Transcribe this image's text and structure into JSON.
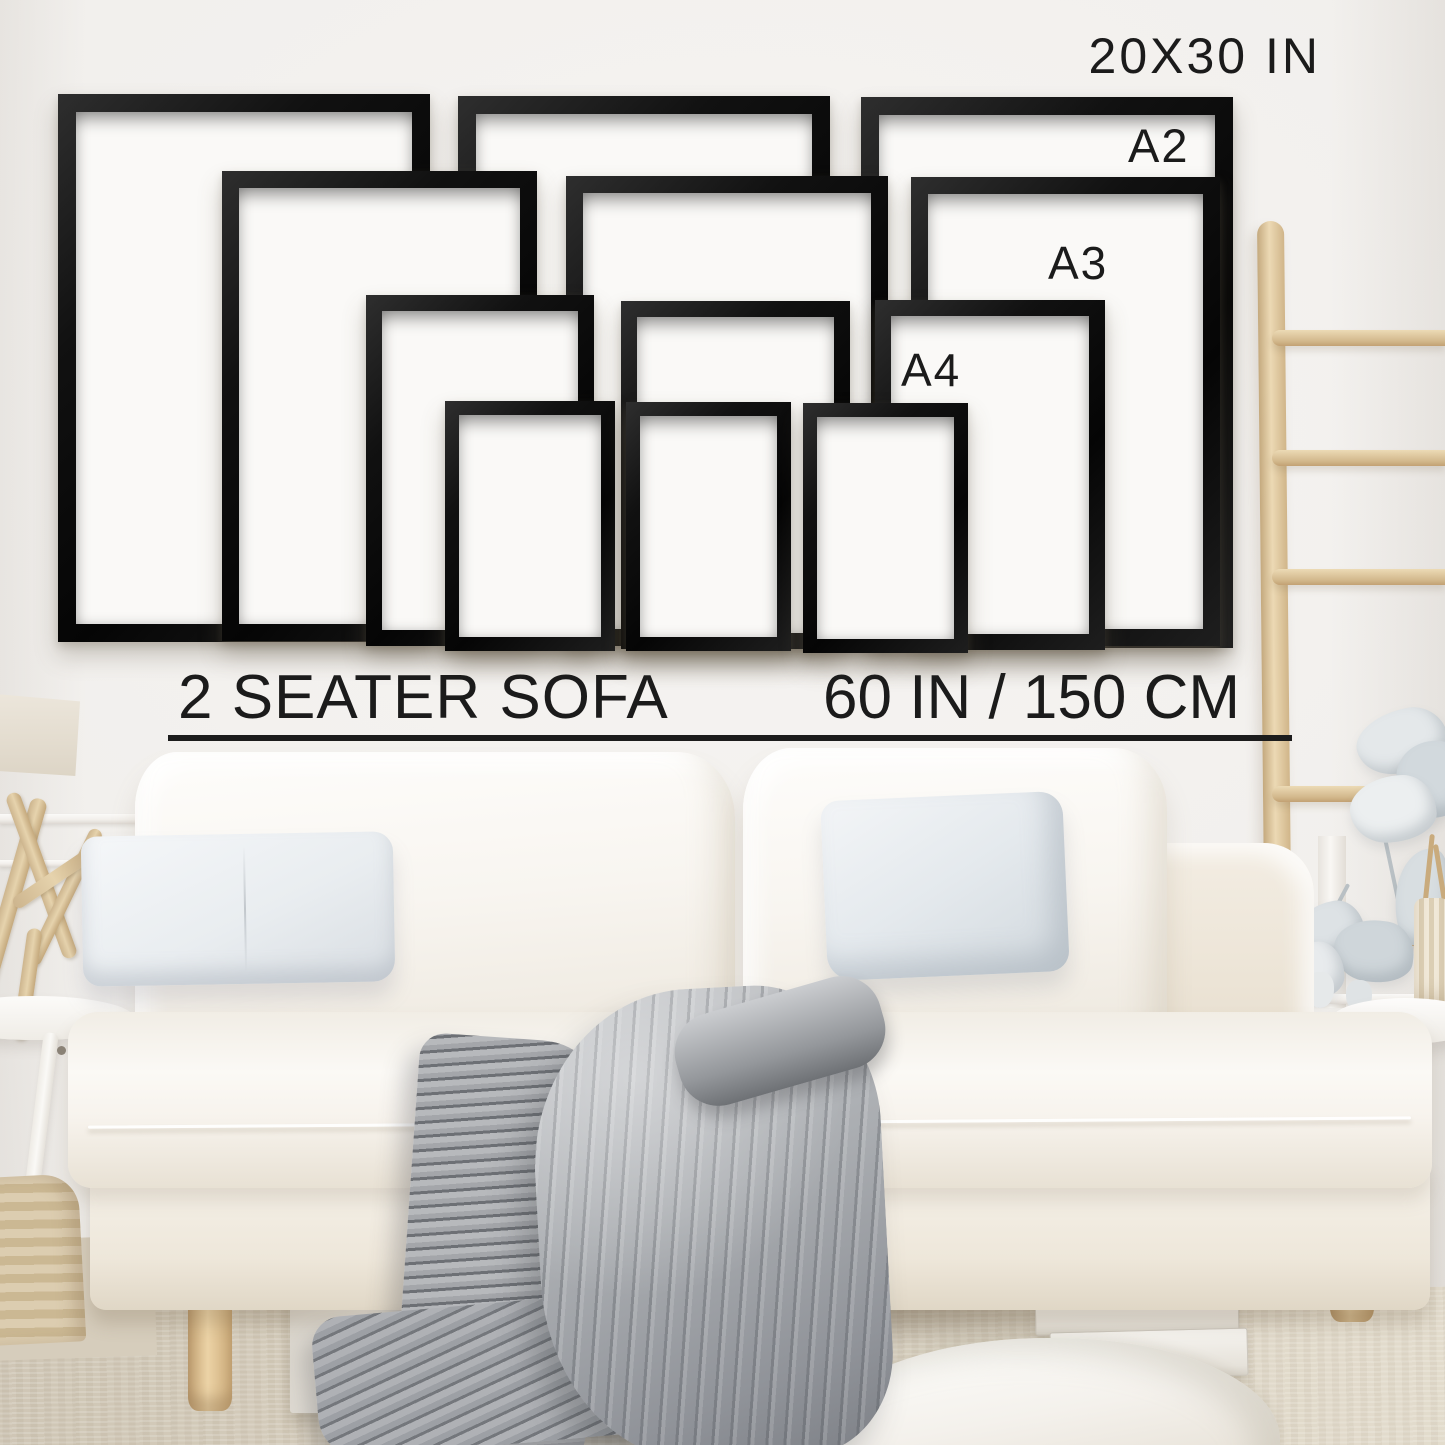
{
  "labels": {
    "top_size": "20X30 IN",
    "a2": "A2",
    "a3": "A3",
    "a4": "A4",
    "sofa": "2 SEATER SOFA",
    "sofa_width": "60 IN / 150 CM"
  },
  "frames": [
    {
      "id": "20x30-left",
      "size_label": "20x30 in",
      "x": 58,
      "y": 94,
      "w": 372,
      "h": 548,
      "border": 18
    },
    {
      "id": "20x30-middle",
      "size_label": "20x30 in",
      "x": 458,
      "y": 96,
      "w": 372,
      "h": 548,
      "border": 18
    },
    {
      "id": "20x30-right",
      "size_label": "20x30 in",
      "x": 861,
      "y": 97,
      "w": 372,
      "h": 551,
      "border": 18
    },
    {
      "id": "a2-left",
      "size_label": "A2",
      "x": 222,
      "y": 171,
      "w": 315,
      "h": 470,
      "border": 17
    },
    {
      "id": "a2-middle",
      "size_label": "A2",
      "x": 566,
      "y": 176,
      "w": 322,
      "h": 470,
      "border": 17
    },
    {
      "id": "a2-right",
      "size_label": "A2",
      "x": 911,
      "y": 177,
      "w": 309,
      "h": 469,
      "border": 17
    },
    {
      "id": "a3-left",
      "size_label": "A3",
      "x": 366,
      "y": 295,
      "w": 228,
      "h": 351,
      "border": 16
    },
    {
      "id": "a3-middle",
      "size_label": "A3",
      "x": 621,
      "y": 301,
      "w": 229,
      "h": 348,
      "border": 16
    },
    {
      "id": "a3-right",
      "size_label": "A3",
      "x": 875,
      "y": 300,
      "w": 230,
      "h": 350,
      "border": 16
    },
    {
      "id": "a4-left",
      "size_label": "A4",
      "x": 445,
      "y": 401,
      "w": 170,
      "h": 250,
      "border": 14
    },
    {
      "id": "a4-middle",
      "size_label": "A4",
      "x": 626,
      "y": 402,
      "w": 165,
      "h": 249,
      "border": 14
    },
    {
      "id": "a4-right",
      "size_label": "A4",
      "x": 803,
      "y": 403,
      "w": 165,
      "h": 250,
      "border": 14
    }
  ],
  "colors": {
    "text": "#1b1b1b",
    "divider": "#1c1c1c",
    "frame_black": "#0e0e0e",
    "frame_paper": "#faf9f7",
    "wall": "#f1efec",
    "sofa_fabric": "#f6f2ea",
    "pillow_grey": "#e7ebee",
    "blanket_grey": "#a7aaae",
    "wood_light": "#e2cba0",
    "carpet_beige": "#d8d0c1"
  }
}
